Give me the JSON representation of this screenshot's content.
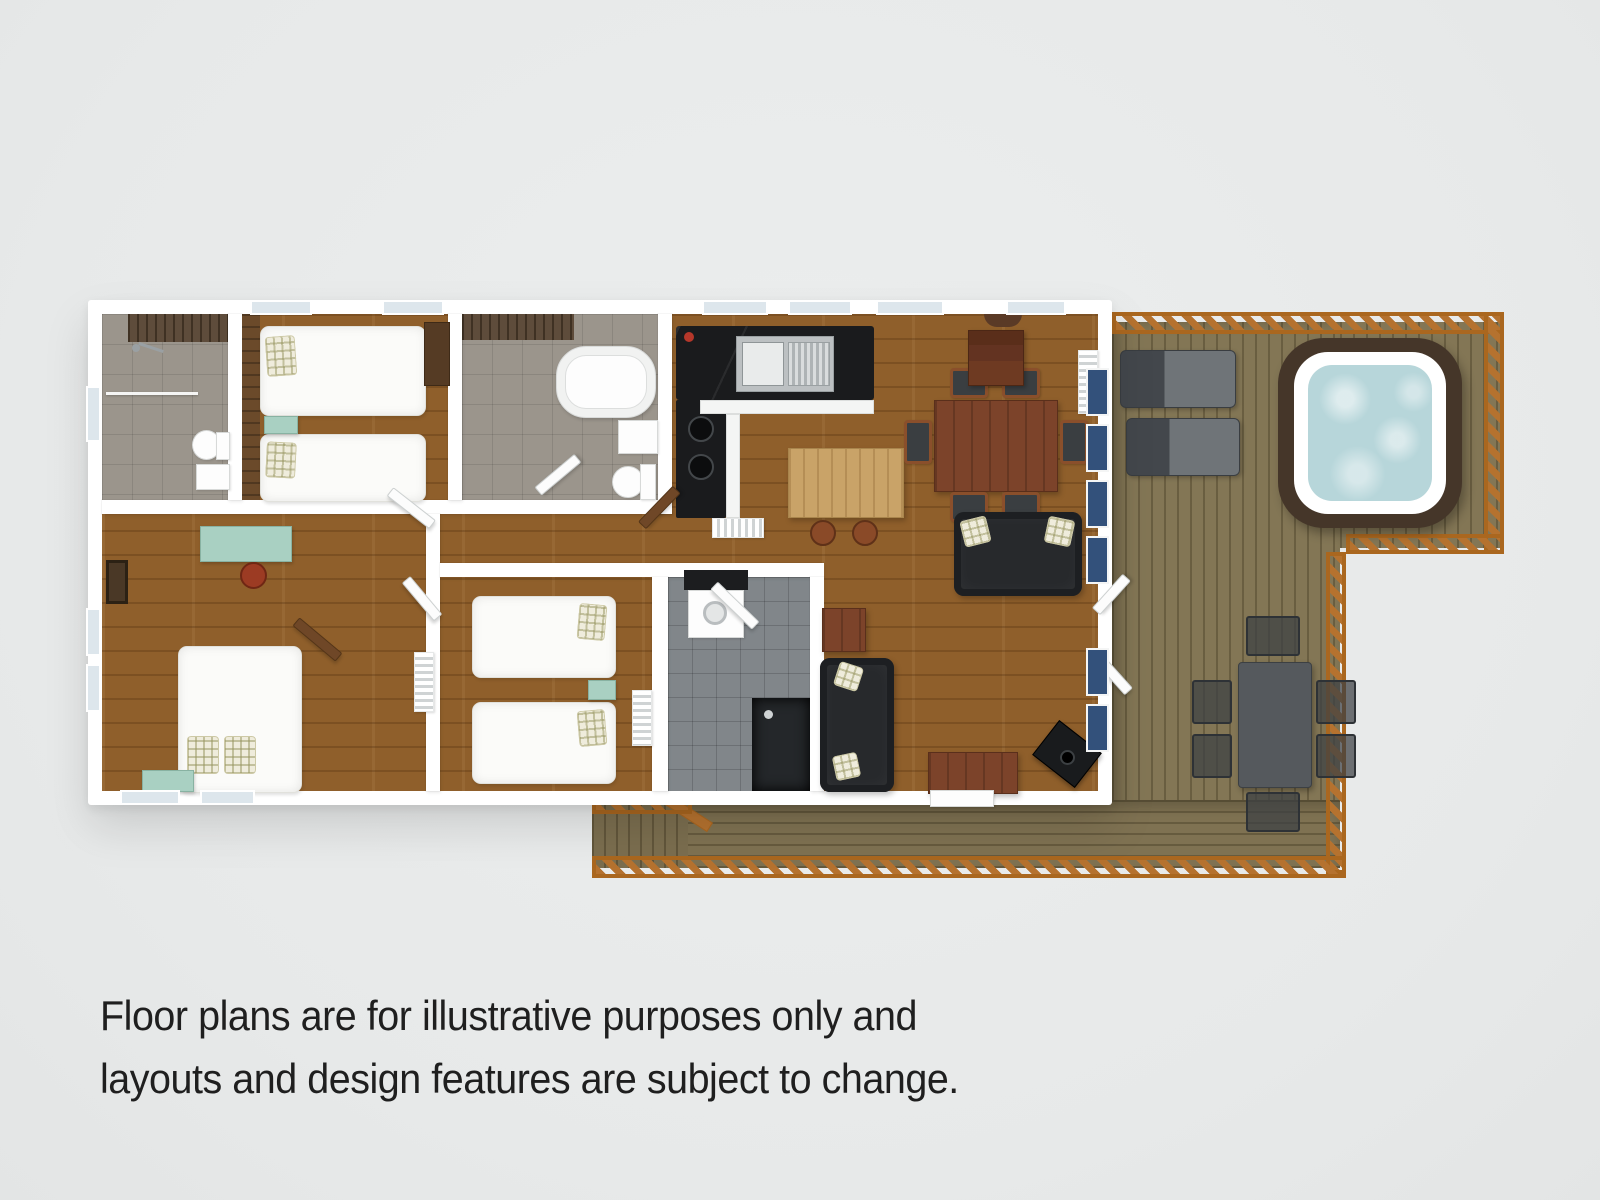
{
  "scene": {
    "background": "#e9ebeb"
  },
  "disclaimer": {
    "line1": "Floor plans are for illustrative purposes only and",
    "line2": "layouts and design features are subject to change.",
    "color": "#1f1f1f"
  },
  "palette": {
    "wall": "#ffffff",
    "wood_floor": "#8f5f2b",
    "stone_floor": "#9b958c",
    "utility_tile": "#81868a",
    "feature_wall": "#54412f",
    "deck_wood": "#837655",
    "deck_railing": "#b5722f",
    "kitchen_counter": "#1a1b1d",
    "island_wood": "#c9a368",
    "dining_table_wood": "#7c432a",
    "sofa_charcoal": "#27292c",
    "plaid_pillow": "#efecdc",
    "mint_accent": "#a9d0c2",
    "hot_tub_casing": "#453629",
    "hot_tub_rim": "#ffffff",
    "hot_tub_water": "#b7d6da",
    "window_glazing": "#33517b",
    "stool_red": "#9c3b23"
  }
}
